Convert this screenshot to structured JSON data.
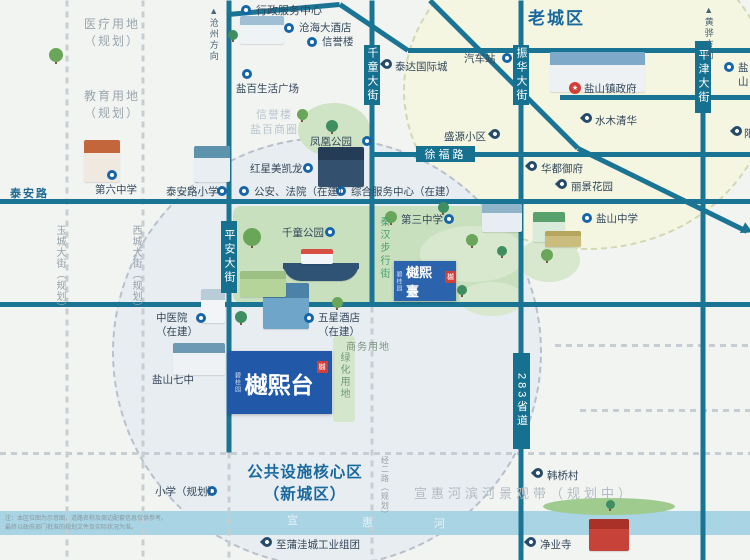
{
  "map": {
    "width": 750,
    "height": 560,
    "bg": "#f2f4f2"
  },
  "palette": {
    "road": "#1a7494",
    "road_label_bg": "#16708f",
    "dashed": "#c6ced3",
    "blue_text": "#19699f",
    "gray_text": "#9aa6ad",
    "poi_text": "#33475a",
    "green_text": "#49a06b",
    "river": "#a8d4e3",
    "park": "#cbe2c2",
    "old_town_fill": "#f4f6e2",
    "old_town_border": "#d2d8b4",
    "new_town_fill": "#e8edf1",
    "new_town_border": "#b7c1c9",
    "logo_blue": "#2158a7",
    "icon_blue": "#1565a8",
    "pin_navy": "#274a68",
    "red": "#d23f38"
  },
  "circles": [
    {
      "name": "old-town-circle",
      "cx": 585,
      "cy": 88,
      "rx": 182,
      "ry": 158,
      "fill": "#f4f6e2",
      "border": "#d2d8b4"
    },
    {
      "name": "new-town-circle",
      "cx": 325,
      "cy": 350,
      "rx": 213,
      "ry": 213,
      "fill": "#e8edf1",
      "border": "#b7c1c9"
    }
  ],
  "shapes": [
    {
      "name": "qianchong-park-area",
      "type": "rect",
      "x": 233,
      "y": 206,
      "w": 287,
      "h": 97,
      "color": "#c9e0bf",
      "radius": 8
    },
    {
      "name": "fenghuang-park-area",
      "type": "ellipse",
      "x": 298,
      "y": 103,
      "w": 72,
      "h": 54,
      "color": "#cfe4c4"
    },
    {
      "name": "green-blob-1",
      "type": "ellipse",
      "x": 420,
      "y": 226,
      "w": 106,
      "h": 56,
      "color": "#d7e8cf"
    },
    {
      "name": "green-blob-2",
      "type": "ellipse",
      "x": 518,
      "y": 238,
      "w": 62,
      "h": 44,
      "color": "#d7e8cf"
    },
    {
      "name": "green-blob-3",
      "type": "ellipse",
      "x": 460,
      "y": 282,
      "w": 64,
      "h": 34,
      "color": "#d7e8cf"
    },
    {
      "name": "greenbelt-strip",
      "type": "rect",
      "x": 333,
      "y": 336,
      "w": 22,
      "h": 86,
      "color": "#d4e6cc",
      "radius": 3
    },
    {
      "name": "river",
      "type": "rect",
      "x": 0,
      "y": 511,
      "w": 750,
      "h": 24,
      "color": "#a8d4e3",
      "radius": 0
    },
    {
      "name": "river-hill",
      "type": "ellipse",
      "x": 543,
      "y": 498,
      "w": 132,
      "h": 17,
      "color": "#9fcb8f"
    }
  ],
  "roads": {
    "solid": [
      {
        "name": "north-road-a",
        "x1": 228,
        "y1": 14,
        "x2": 340,
        "y2": 4
      },
      {
        "name": "north-road-b",
        "x1": 340,
        "y1": 4,
        "x2": 408,
        "y2": 50
      },
      {
        "name": "north-road-c",
        "x1": 408,
        "y1": 50,
        "x2": 750,
        "y2": 50
      },
      {
        "name": "diagonal-road-a",
        "x1": 430,
        "y1": 0,
        "x2": 578,
        "y2": 148
      },
      {
        "name": "diagonal-road-b",
        "x1": 578,
        "y1": 148,
        "x2": 747,
        "y2": 231
      },
      {
        "name": "xufu-road",
        "x1": 372,
        "y1": 154,
        "x2": 750,
        "y2": 154
      },
      {
        "name": "taian-road",
        "x1": 0,
        "y1": 201,
        "x2": 750,
        "y2": 201
      },
      {
        "name": "east-cross-road",
        "x1": 560,
        "y1": 97,
        "x2": 750,
        "y2": 97
      },
      {
        "name": "mid-cross-road",
        "x1": 0,
        "y1": 304,
        "x2": 750,
        "y2": 304
      },
      {
        "name": "pingan-street",
        "x1": 229,
        "y1": 0,
        "x2": 229,
        "y2": 452
      },
      {
        "name": "qianchong-street",
        "x1": 372,
        "y1": 0,
        "x2": 372,
        "y2": 306
      },
      {
        "name": "zhenhua-s283-road",
        "x1": 521,
        "y1": 0,
        "x2": 521,
        "y2": 560
      },
      {
        "name": "pingjin-street",
        "x1": 703,
        "y1": 45,
        "x2": 703,
        "y2": 560
      }
    ],
    "dashed": [
      {
        "name": "yucheng-street-planned",
        "x1": 67,
        "y1": 0,
        "x2": 67,
        "y2": 560
      },
      {
        "name": "xicheng-street-planned",
        "x1": 143,
        "y1": 0,
        "x2": 143,
        "y2": 560
      },
      {
        "name": "pingan-south-planned",
        "x1": 229,
        "y1": 452,
        "x2": 229,
        "y2": 560
      },
      {
        "name": "jinger-road-planned",
        "x1": 372,
        "y1": 306,
        "x2": 372,
        "y2": 560
      },
      {
        "name": "dashed-east-1",
        "x1": 555,
        "y1": 345,
        "x2": 750,
        "y2": 345
      },
      {
        "name": "dashed-east-2",
        "x1": 580,
        "y1": 410,
        "x2": 750,
        "y2": 410
      },
      {
        "name": "dashed-full-south",
        "x1": 0,
        "y1": 453,
        "x2": 750,
        "y2": 453
      }
    ],
    "arrow": {
      "name": "diagonal-road-arrow",
      "x": 742,
      "y": 224,
      "rot": 26
    }
  },
  "road_labels": [
    {
      "name": "pingan-street-label",
      "text": "平安大街",
      "x": 221,
      "y": 221,
      "w": 16,
      "h": 72,
      "vertical": true
    },
    {
      "name": "qianchong-street-label",
      "text": "千童大街",
      "x": 364,
      "y": 45,
      "w": 16,
      "h": 60,
      "vertical": true
    },
    {
      "name": "zhenhua-street-label",
      "text": "振华大街",
      "x": 513,
      "y": 45,
      "w": 16,
      "h": 60,
      "vertical": true
    },
    {
      "name": "pingjin-street-label",
      "text": "平津大街",
      "x": 695,
      "y": 41,
      "w": 16,
      "h": 72,
      "vertical": true
    },
    {
      "name": "s283-road-label",
      "text": "283省道",
      "x": 513,
      "y": 353,
      "w": 17,
      "h": 96,
      "vertical": true
    },
    {
      "name": "xufu-road-label",
      "text": "徐福路",
      "x": 416,
      "y": 146,
      "w": 59,
      "h": 16,
      "vertical": false
    }
  ],
  "pois": [
    {
      "name": "poi-xingzheng-center",
      "icon": "circle",
      "ix": 246,
      "iy": 10,
      "label": "行政服务中心",
      "lx": 256,
      "ly": 4,
      "size": 11
    },
    {
      "name": "poi-canghai-hotel",
      "icon": "circle",
      "ix": 289,
      "iy": 28,
      "label": "沧海大酒店",
      "lx": 299,
      "ly": 22
    },
    {
      "name": "poi-xinyulou",
      "icon": "circle",
      "ix": 312,
      "iy": 42,
      "label": "信誉楼",
      "lx": 322,
      "ly": 36
    },
    {
      "name": "poi-yanbai-plaza",
      "icon": "circle",
      "ix": 247,
      "iy": 74,
      "label": "盐百生活广场",
      "lx": 236,
      "ly": 83
    },
    {
      "name": "poi-fenghuang-park",
      "icon": "circle",
      "ix": 367,
      "iy": 141,
      "label": "凤凰公园",
      "lx": 310,
      "ly": 136
    },
    {
      "name": "poi-hongxing",
      "icon": "circle",
      "ix": 308,
      "iy": 168,
      "label": "红星美凯龙",
      "lx": 250,
      "ly": 163
    },
    {
      "name": "poi-gongan-fayuan",
      "icon": "circle",
      "ix": 244,
      "iy": 191,
      "label": "公安、法院（在建）",
      "lx": 254,
      "ly": 186
    },
    {
      "name": "poi-zonghe-center",
      "icon": "circle",
      "ix": 341,
      "iy": 191,
      "label": "综合服务中心（在建）",
      "lx": 351,
      "ly": 186
    },
    {
      "name": "poi-diliu-zhongxue",
      "icon": "circle",
      "ix": 112,
      "iy": 175,
      "label": "第六中学",
      "lx": 95,
      "ly": 184
    },
    {
      "name": "poi-taianlu-xiaoxue",
      "icon": "circle",
      "ix": 222,
      "iy": 191,
      "label": "泰安路小学",
      "lx": 166,
      "ly": 186
    },
    {
      "name": "poi-qianchong-park",
      "icon": "circle",
      "ix": 330,
      "iy": 232,
      "label": "千童公园",
      "lx": 282,
      "ly": 227
    },
    {
      "name": "poi-disan-zhongxue",
      "icon": "circle",
      "ix": 449,
      "iy": 219,
      "label": "第三中学",
      "lx": 401,
      "ly": 214
    },
    {
      "name": "poi-shengyuan",
      "icon": "pin",
      "ix": 495,
      "iy": 136,
      "label": "盛源小区",
      "lx": 444,
      "ly": 131
    },
    {
      "name": "poi-huadu-yufu",
      "icon": "pin",
      "ix": 532,
      "iy": 168,
      "label": "华都御府",
      "lx": 541,
      "ly": 163
    },
    {
      "name": "poi-lijing-huayuan",
      "icon": "pin",
      "ix": 562,
      "iy": 186,
      "label": "丽景花园",
      "lx": 571,
      "ly": 181
    },
    {
      "name": "poi-yanshan-zhenfu",
      "icon": "red",
      "ix": 575,
      "iy": 88,
      "label": "盐山镇政府",
      "lx": 584,
      "ly": 83
    },
    {
      "name": "poi-shuimu-qinghua",
      "icon": "pin",
      "ix": 587,
      "iy": 120,
      "label": "水木清华",
      "lx": 595,
      "ly": 115
    },
    {
      "name": "poi-yanshan-zhongxue",
      "icon": "circle",
      "ix": 587,
      "iy": 218,
      "label": "盐山中学",
      "lx": 596,
      "ly": 213
    },
    {
      "name": "poi-qichezhan",
      "icon": "circle",
      "ix": 507,
      "iy": 58,
      "label": "汽车站",
      "lx": 464,
      "ly": 53
    },
    {
      "name": "poi-taida-guojicheng",
      "icon": "pin",
      "ix": 387,
      "iy": 66,
      "label": "泰达国际城",
      "lx": 395,
      "ly": 61
    },
    {
      "name": "poi-zhongyiyuan",
      "icon": "circle",
      "ix": 201,
      "iy": 318,
      "label": "中医院\n（在建）",
      "lx": 156,
      "ly": 312
    },
    {
      "name": "poi-wuxing-hotel",
      "icon": "circle",
      "ix": 309,
      "iy": 318,
      "label": "五星酒店\n（在建）",
      "lx": 318,
      "ly": 312
    },
    {
      "name": "poi-yanshan-qizhong",
      "icon": "none",
      "ix": 0,
      "iy": 0,
      "label": "盐山七中",
      "lx": 152,
      "ly": 374
    },
    {
      "name": "poi-xiaoxue-guihua",
      "icon": "circle",
      "ix": 212,
      "iy": 491,
      "label": "小学（规划）",
      "lx": 155,
      "ly": 486
    },
    {
      "name": "poi-hanqiao-cun",
      "icon": "pin",
      "ix": 538,
      "iy": 475,
      "label": "韩桥村",
      "lx": 547,
      "ly": 470
    },
    {
      "name": "poi-jingye-si",
      "icon": "pin",
      "ix": 531,
      "iy": 544,
      "label": "净业寺",
      "lx": 540,
      "ly": 539
    },
    {
      "name": "poi-puwacheng",
      "icon": "pin",
      "ix": 267,
      "iy": 544,
      "label": "至蒲洼城工业组团",
      "lx": 276,
      "ly": 539
    },
    {
      "name": "poi-yanshan-east",
      "icon": "circle",
      "ix": 729,
      "iy": 67,
      "label": "盐山",
      "lx": 738,
      "ly": 62
    },
    {
      "name": "poi-yangguang-east",
      "icon": "pin",
      "ix": 737,
      "iy": 133,
      "label": "阳",
      "lx": 744,
      "ly": 128
    }
  ],
  "texts": [
    {
      "name": "old-town-label",
      "text": "老城区",
      "x": 528,
      "y": 8,
      "size": 17,
      "color": "#19699f",
      "weight": "bold",
      "ls": 2
    },
    {
      "name": "yiliao-planned-label",
      "text": "医疗用地\n（规划）",
      "x": 80,
      "y": 16,
      "size": 12,
      "color": "#9aa6ad",
      "ls": 2,
      "width": 64,
      "align": "center",
      "lh": 1.45
    },
    {
      "name": "jiaoyu-planned-label",
      "text": "教育用地\n（规划）",
      "x": 80,
      "y": 88,
      "size": 12,
      "color": "#9aa6ad",
      "ls": 2,
      "width": 64,
      "align": "center",
      "lh": 1.45
    },
    {
      "name": "core-area-label",
      "text": "公共设施核心区\n（新城区）",
      "x": 238,
      "y": 462,
      "size": 15.5,
      "color": "#19699f",
      "weight": "bold",
      "width": 134,
      "align": "center",
      "lh": 1.4,
      "ls": 1
    },
    {
      "name": "riverfront-belt-label",
      "text": "宣惠河滨河景观带（规划中）",
      "x": 414,
      "y": 486,
      "size": 13,
      "color": "#b2bcc2",
      "ls": 4,
      "nowrap": true
    },
    {
      "name": "taian-road-label",
      "text": "泰安路",
      "x": 10,
      "y": 187,
      "size": 11,
      "color": "#1c6a92",
      "weight": "bold",
      "ls": 2
    },
    {
      "name": "qinhan-street-label",
      "text": "秦汉步行街",
      "x": 377,
      "y": 216,
      "size": 10,
      "color": "#49a06b",
      "vertical": true,
      "ls": 3
    },
    {
      "name": "yucheng-street-label",
      "text": "玉城大街（规划）",
      "x": 53,
      "y": 225,
      "size": 10,
      "color": "#97a2ab",
      "vertical": true,
      "ls": 1
    },
    {
      "name": "xicheng-street-label",
      "text": "西城大街（规划）",
      "x": 129,
      "y": 225,
      "size": 10,
      "color": "#97a2ab",
      "vertical": true,
      "ls": 1
    },
    {
      "name": "jinger-road-label",
      "text": "经二路（规划）",
      "x": 379,
      "y": 456,
      "size": 8,
      "color": "#98a2aa",
      "vertical": true,
      "ls": 1
    },
    {
      "name": "cangzhou-direction",
      "text": "▲沧州方向",
      "x": 207,
      "y": 6,
      "size": 9,
      "color": "#4a6374",
      "vertical": true,
      "ls": 2
    },
    {
      "name": "huanghua-direction",
      "text": "▲黄骅方向",
      "x": 702,
      "y": 5,
      "size": 9,
      "color": "#4a6374",
      "vertical": true,
      "ls": 2
    },
    {
      "name": "shangwu-yongdi-label",
      "text": "商务用地",
      "x": 346,
      "y": 341,
      "size": 10,
      "color": "#7b9383",
      "ls": 1
    },
    {
      "name": "lvhua-yongdi-label",
      "text": "绿化用地",
      "x": 337,
      "y": 352,
      "size": 10,
      "color": "#6f9a78",
      "vertical": true,
      "ls": 2
    },
    {
      "name": "xinyu-shangquan-label",
      "text": "信誉楼\n盐百商圈",
      "x": 244,
      "y": 108,
      "size": 11,
      "color": "#b9c6ce",
      "width": 60,
      "align": "center",
      "lh": 1.35,
      "ls": 1
    },
    {
      "name": "river-char-xuan",
      "text": "宣",
      "x": 287,
      "y": 514,
      "size": 11,
      "color": "#e4f2f7"
    },
    {
      "name": "river-char-hui",
      "text": "惠",
      "x": 362,
      "y": 516,
      "size": 11,
      "color": "#e4f2f7"
    },
    {
      "name": "river-char-he",
      "text": "河",
      "x": 434,
      "y": 517,
      "size": 11,
      "color": "#e4f2f7"
    },
    {
      "name": "disclaimer-line-1",
      "text": "注：本区位图为示意图，道路名称及周边配套信息仅供参考。",
      "x": 5,
      "y": 516,
      "size": 6,
      "color": "#8b98a0"
    },
    {
      "name": "disclaimer-line-2",
      "text": "最终以政府部门批准的规划文件及实际状况为准。",
      "x": 5,
      "y": 525,
      "size": 6,
      "color": "#8b98a0"
    }
  ],
  "illustrations": [
    {
      "name": "building-diliu-zhongxue",
      "x": 84,
      "y": 140,
      "w": 36,
      "h": 42,
      "body": "#f0e9df",
      "roof": "#c4663c"
    },
    {
      "name": "building-taianlu-xiaoxue",
      "x": 194,
      "y": 146,
      "w": 36,
      "h": 36,
      "body": "#e8eef2",
      "roof": "#5e93ad"
    },
    {
      "name": "building-xingzheng",
      "x": 240,
      "y": 16,
      "w": 44,
      "h": 28,
      "body": "#eef3f6",
      "roof": "#9fc0d4"
    },
    {
      "name": "building-zhenfu",
      "x": 550,
      "y": 52,
      "w": 95,
      "h": 40,
      "body": "#edf1f4",
      "roof": "#7fa9c9"
    },
    {
      "name": "building-hongxing",
      "x": 318,
      "y": 147,
      "w": 46,
      "h": 40,
      "body": "#33516f",
      "roof": "#243c55"
    },
    {
      "name": "building-school-east",
      "x": 482,
      "y": 204,
      "w": 40,
      "h": 28,
      "body": "#e7edf2",
      "roof": "#8fb4c9"
    },
    {
      "name": "building-green-school",
      "x": 533,
      "y": 212,
      "w": 32,
      "h": 30,
      "body": "#d9ecdc",
      "roof": "#58a06c"
    },
    {
      "name": "sports-field",
      "x": 545,
      "y": 231,
      "w": 36,
      "h": 16,
      "body": "#cbbd7e",
      "roof": "#b5a55f"
    },
    {
      "name": "building-wuxing-hotel",
      "x": 263,
      "y": 283,
      "w": 46,
      "h": 46,
      "body": "#6fa5c8",
      "roof": "#4c81a8"
    },
    {
      "name": "building-zhongyiyuan",
      "x": 201,
      "y": 289,
      "w": 24,
      "h": 34,
      "body": "#f2f5f7",
      "roof": "#b9cdd8"
    },
    {
      "name": "building-qizhong",
      "x": 173,
      "y": 343,
      "w": 52,
      "h": 32,
      "body": "#eef2f5",
      "roof": "#6e99b5"
    },
    {
      "name": "temple-jingyesi",
      "x": 589,
      "y": 519,
      "w": 40,
      "h": 32,
      "body": "#c7433a",
      "roof": "#a93128"
    },
    {
      "name": "park-ship-hull",
      "x": 283,
      "y": 263,
      "w": 76,
      "h": 18,
      "body": "#2e5375",
      "roof": "#2e5375",
      "round": "0 0 18px 18px"
    },
    {
      "name": "park-ship-cabin",
      "x": 301,
      "y": 249,
      "w": 32,
      "h": 15,
      "body": "#f2f6f8",
      "roof": "#d84f44"
    },
    {
      "name": "park-playfield",
      "x": 240,
      "y": 271,
      "w": 46,
      "h": 26,
      "body": "#b4d49a",
      "roof": "#9cc084"
    }
  ],
  "trees": [
    {
      "x": 56,
      "y": 62,
      "s": 14
    },
    {
      "x": 233,
      "y": 40,
      "s": 10
    },
    {
      "x": 302,
      "y": 120,
      "s": 11
    },
    {
      "x": 332,
      "y": 132,
      "s": 12
    },
    {
      "x": 391,
      "y": 223,
      "s": 12
    },
    {
      "x": 443,
      "y": 213,
      "s": 11
    },
    {
      "x": 472,
      "y": 246,
      "s": 12
    },
    {
      "x": 502,
      "y": 256,
      "s": 10
    },
    {
      "x": 547,
      "y": 261,
      "s": 12
    },
    {
      "x": 241,
      "y": 323,
      "s": 12
    },
    {
      "x": 337,
      "y": 308,
      "s": 11
    },
    {
      "x": 462,
      "y": 295,
      "s": 10
    },
    {
      "x": 252,
      "y": 246,
      "s": 18
    },
    {
      "x": 610,
      "y": 509,
      "s": 9
    }
  ],
  "logos": {
    "main": {
      "x": 228,
      "y": 351,
      "w": 104,
      "h": 63,
      "text": "樾熙台",
      "sub": "碧桂园",
      "seal": "樾",
      "bg": "#2158a7",
      "font": 23
    },
    "small": {
      "x": 394,
      "y": 261,
      "w": 62,
      "h": 40,
      "text": "樾熙臺",
      "sub": "碧桂园",
      "seal": "樾",
      "bg": "#2b63ad",
      "font": 13
    }
  }
}
